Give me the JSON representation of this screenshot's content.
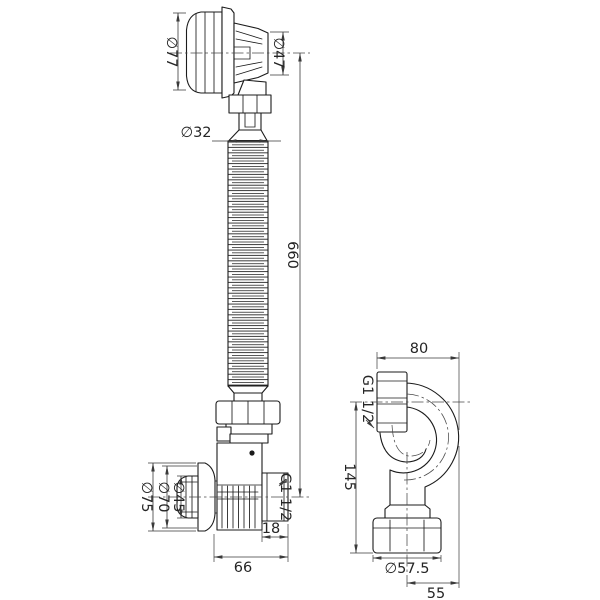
{
  "drawing": {
    "type": "technical-drawing",
    "subject": "bath drain overflow siphon with flexible hose and outlet bend",
    "line_color": "#1b1b1b",
    "background": "#ffffff",
    "dimensions": {
      "cap_diameter": "∅77",
      "head_diameter": "∅47",
      "hose_diameter": "∅32",
      "hose_length": "660",
      "flange_outer_diameter": "∅75",
      "flange_inner_diameter": "∅70",
      "plug_diameter": "∅45",
      "outlet_thread": "G1 1/2",
      "outlet_thread_length": "18",
      "body_width": "66",
      "trap_width": "80",
      "trap_thread": "G1 1/2",
      "trap_height": "145",
      "trap_nut_diameter": "∅57.5",
      "trap_outlet_offset": "55"
    }
  }
}
